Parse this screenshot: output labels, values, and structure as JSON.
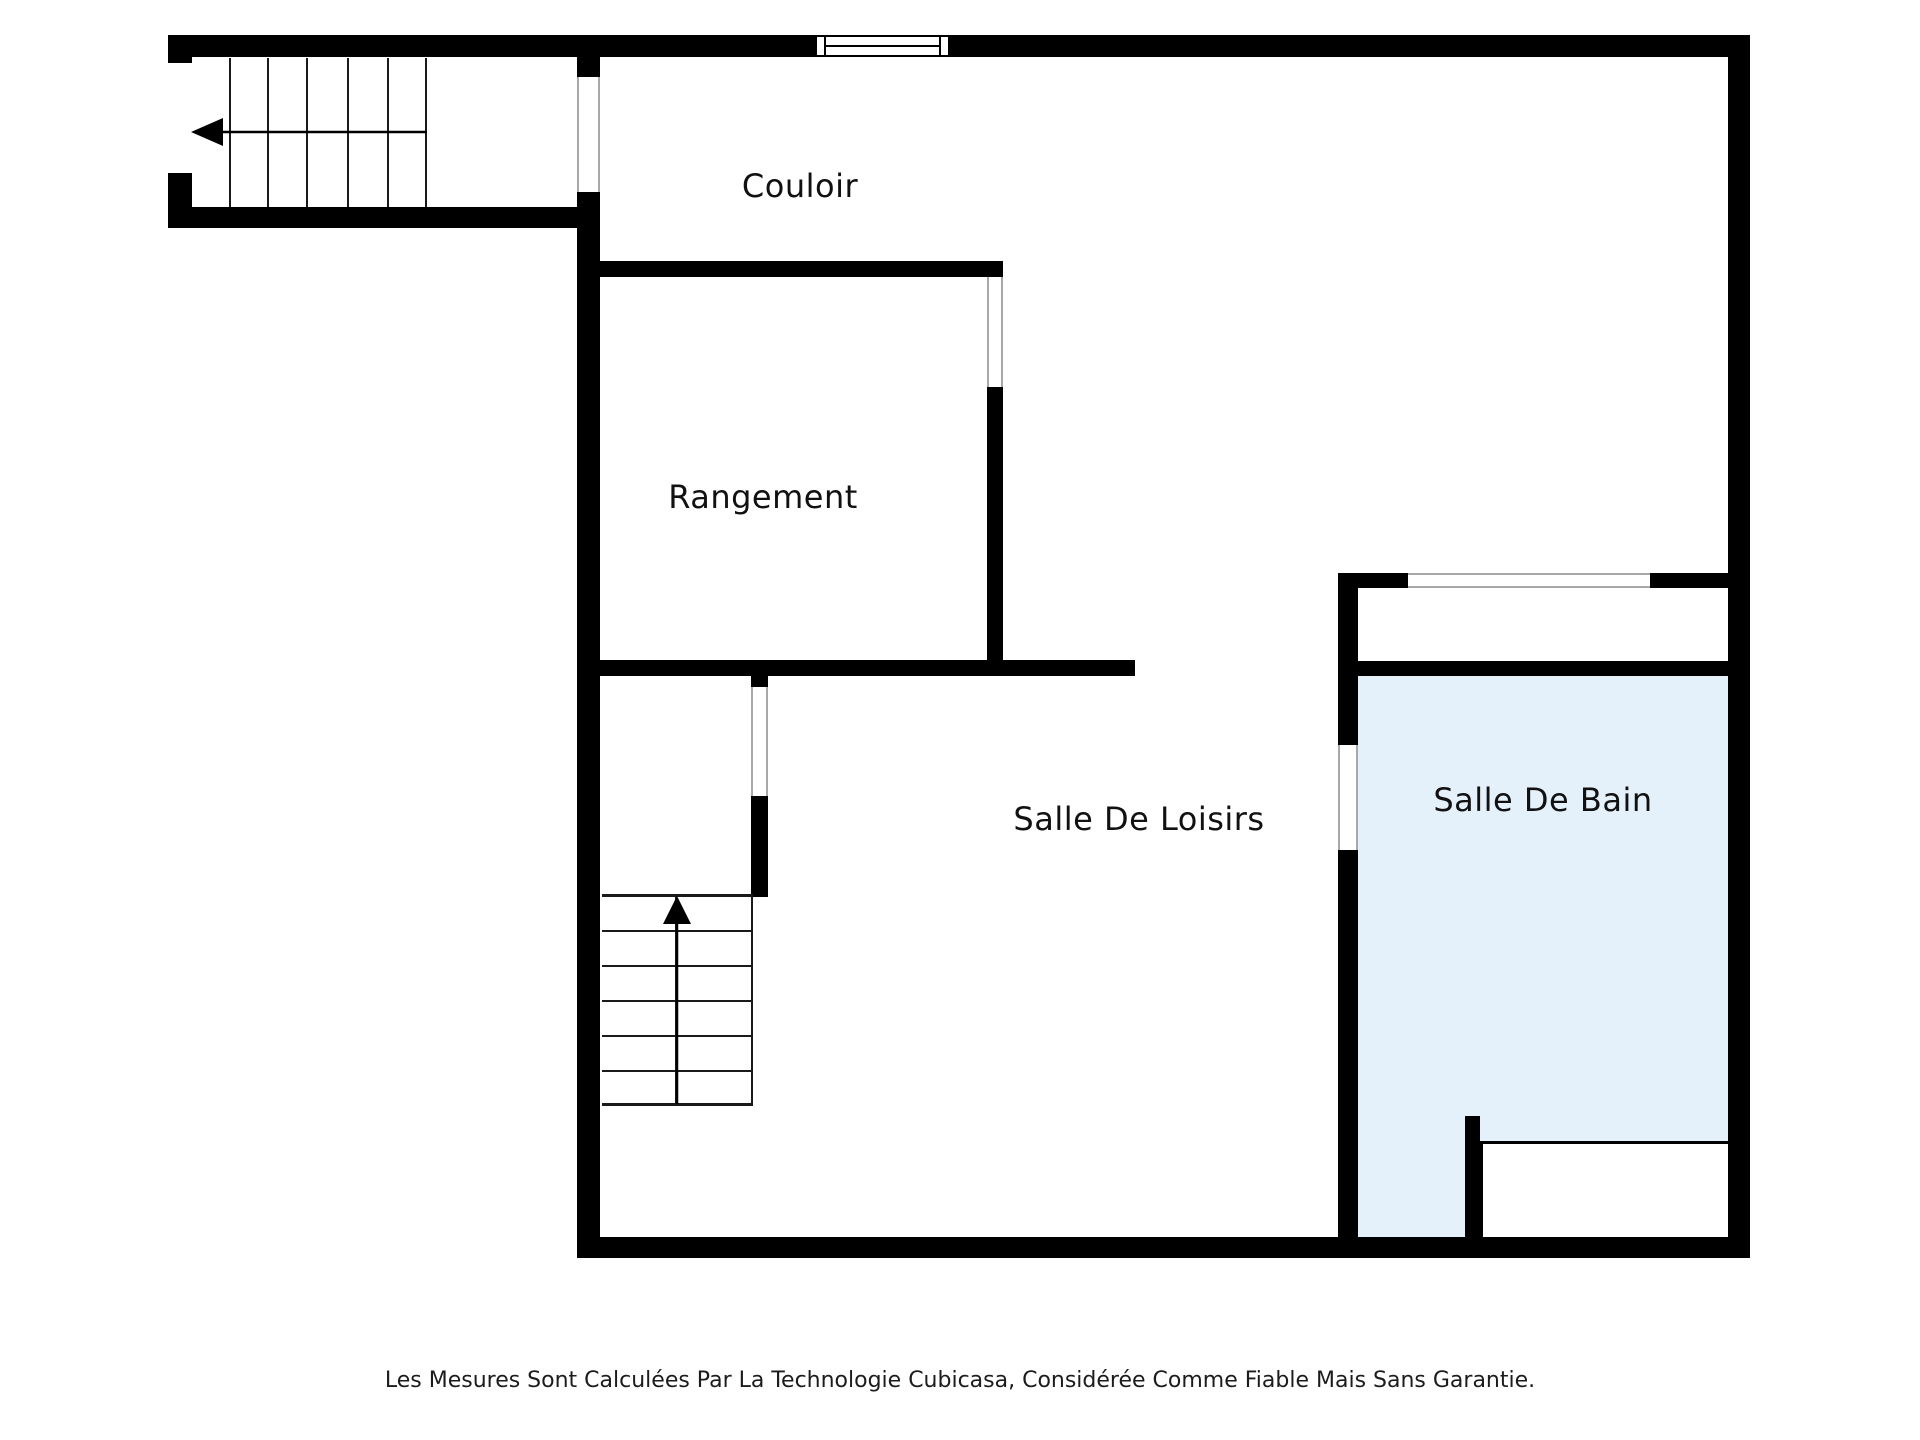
{
  "plan": {
    "type": "floorplan",
    "source_brand_mentioned": "Cubicasa",
    "rooms": [
      {
        "id": "couloir",
        "label": "Couloir"
      },
      {
        "id": "rangement",
        "label": "Rangement"
      },
      {
        "id": "loisirs",
        "label": "Salle De Loisirs"
      },
      {
        "id": "bain",
        "label": "Salle De Bain"
      }
    ],
    "features": [
      {
        "name": "staircase-upper-left",
        "treads": 6,
        "direction": "left"
      },
      {
        "name": "staircase-middle",
        "treads": 6,
        "direction": "up"
      },
      {
        "name": "window-top-wall"
      },
      {
        "name": "bathroom-counter"
      }
    ]
  },
  "footer": {
    "disclaimer": "Les Mesures Sont Calculées Par La Technologie Cubicasa, Considérée Comme Fiable Mais Sans Garantie."
  },
  "colors": {
    "wall": "#000000",
    "background": "#FFFFFF",
    "bathroom_floor": "#E4F1FB",
    "door_jamb": "#A8A8A8",
    "text": "#111111"
  }
}
